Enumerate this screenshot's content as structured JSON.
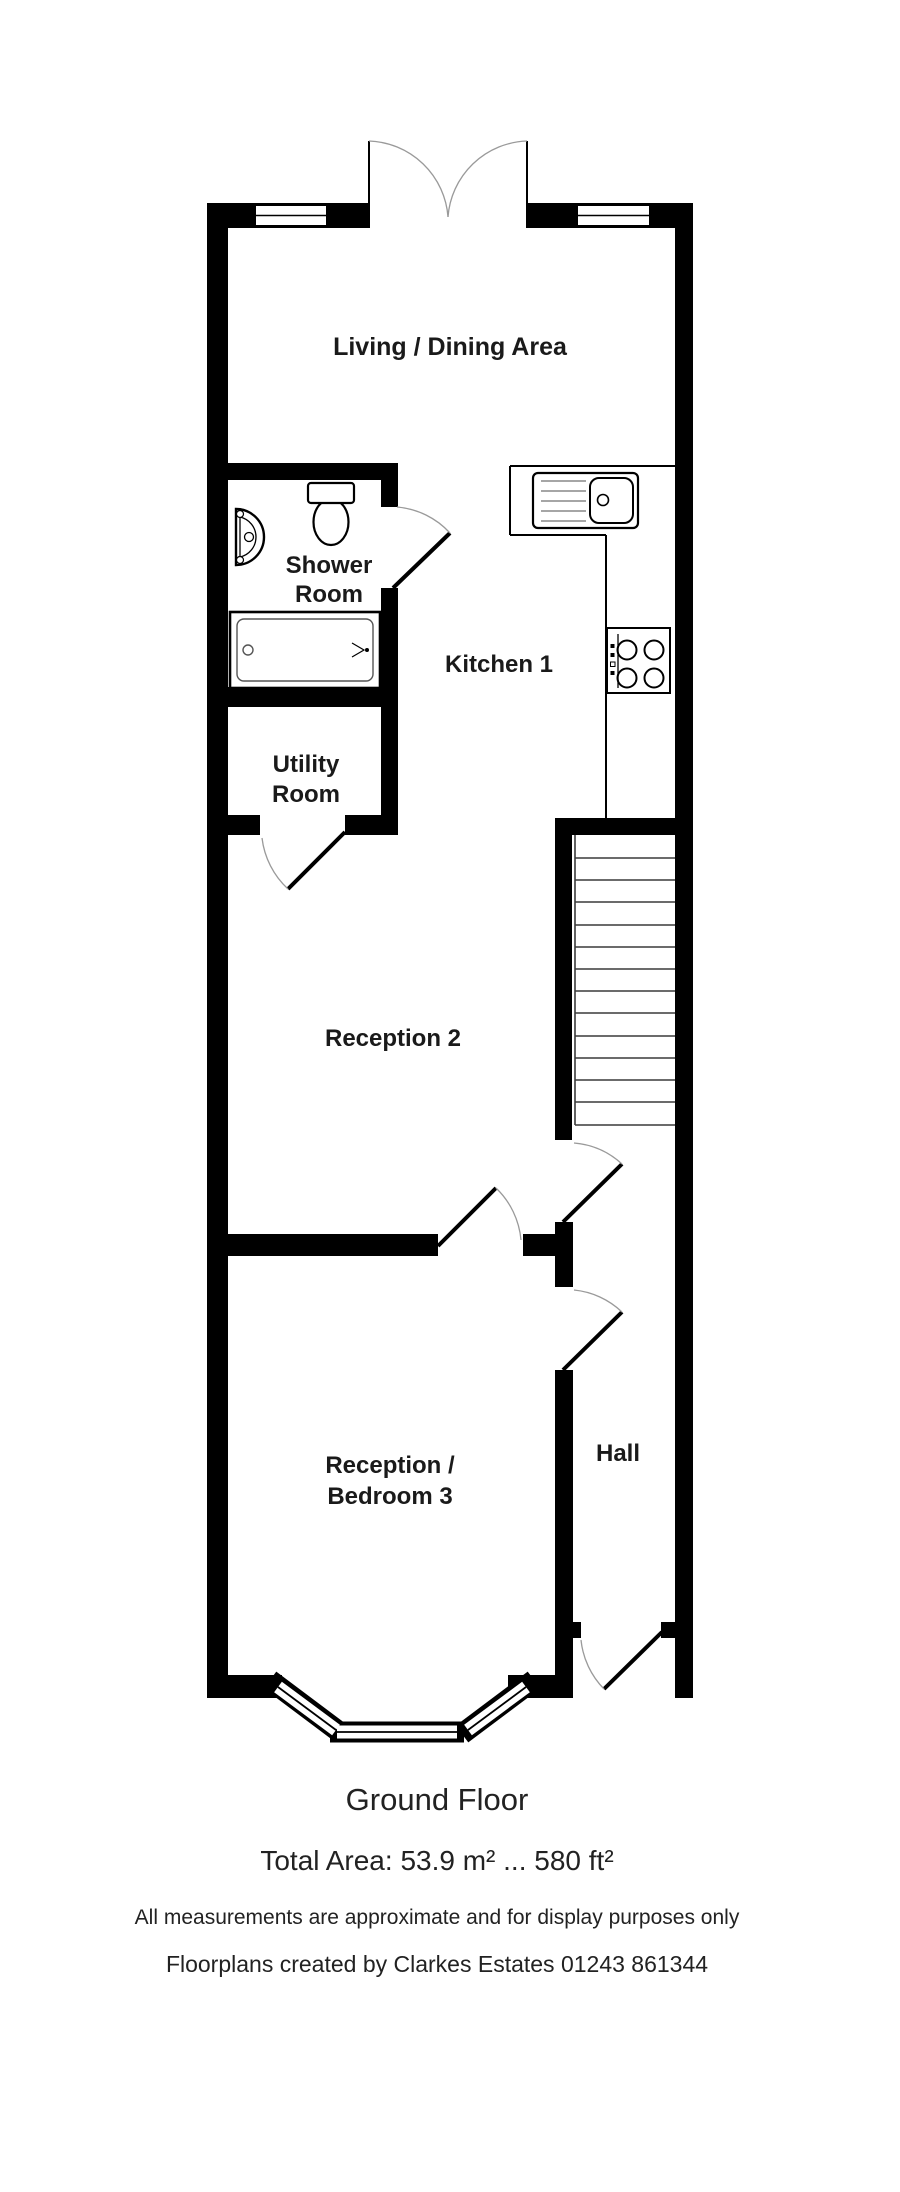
{
  "plan": {
    "labels": {
      "living_dining": "Living / Dining Area",
      "shower_line1": "Shower",
      "shower_line2": "Room",
      "kitchen": "Kitchen 1",
      "utility_line1": "Utility",
      "utility_line2": "Room",
      "reception2": "Reception 2",
      "reception3_line1": "Reception /",
      "reception3_line2": "Bedroom 3",
      "hall": "Hall"
    },
    "fixtures": [
      "toilet",
      "basin",
      "bath",
      "kitchen-sink-drainer",
      "hob",
      "staircase"
    ],
    "doors": [
      "entry-double-door",
      "shower-room-door",
      "utility-room-door",
      "stairs-hall-door",
      "bedroom3-hall-door",
      "reception-divider-door",
      "front-door"
    ],
    "windows": [
      "top-left-window",
      "top-right-window",
      "bay-window"
    ]
  },
  "footer": {
    "title": "Ground Floor",
    "total_area": "Total Area: 53.9 m² ... 580 ft²",
    "disclaimer": "All measurements are approximate and for display purposes only",
    "credit": "Floorplans created by Clarkes Estates 01243 861344"
  },
  "colors": {
    "wall": "#000000",
    "background": "#ffffff",
    "door_arc": "#9a9a9a",
    "text": "#1a1a1a"
  }
}
